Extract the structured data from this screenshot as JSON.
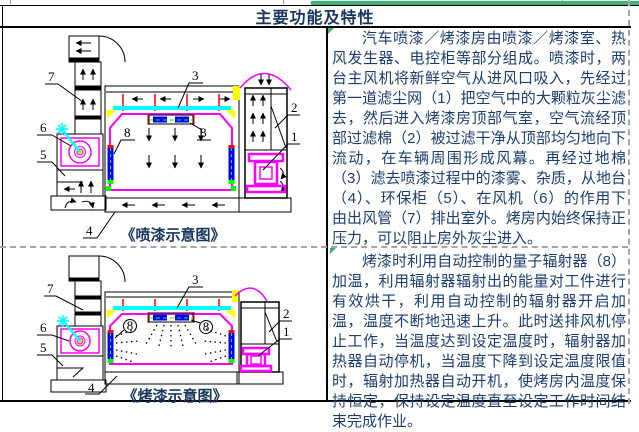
{
  "title": "主要功能及特性",
  "text_panel": {
    "para1": "汽车喷漆／烤漆房由喷漆／烤漆室、热风发生器、电控柜等部分组成。喷漆时，两台主风机将新鲜空气从进风口吸入，先经过第一道滤尘网（1）把空气中的大颗粒灰尘滤去，然后进入烤漆房顶部气室，空气流经顶部过滤棉（2）被过滤干净从顶部均匀地向下流动，在车辆周围形成风幕。再经过地棉（3）滤去喷漆过程中的漆雾、杂质，从地台（4）、环保柜（5）、在风机（6）的作用下由出风管（7）排出室外。烤房内始终保持正压力，可以阻止房外灰尘进入。",
    "para2": "烤漆时利用自动控制的量子辐射器（8）加温，利用辐射器辐射出的能量对工件进行有效烘干，利用自动控制的辐射器开启加温，温度不断地迅速上升。此时送排风机停止工作，当温度达到设定温度时，辐射器加热器自动停机，当温度下降到设定温度限值时，辐射加热器自动开机，使烤房内温度保持恒定，保持设定温度直至设定工作时间结束完成作业。"
  },
  "diagram1": {
    "caption": "《喷漆示意图》",
    "labels": {
      "n1": "1",
      "n2": "2",
      "n3": "3",
      "n4": "4",
      "n5": "5",
      "n6": "6",
      "n7": "7",
      "n8": "8"
    }
  },
  "diagram2": {
    "caption": "《烤漆示意图》",
    "labels": {
      "n1": "1",
      "n2": "2",
      "n3": "3",
      "n4": "4",
      "n5": "5",
      "n6": "6",
      "n7": "7",
      "n8": "8"
    }
  },
  "colors": {
    "text_navy": "#1c3e6e",
    "caption_navy": "#17365d",
    "accent_green": "#3cb371",
    "magenta": "#ff00ff",
    "cyan": "#00ffff",
    "yellow": "#ffff00",
    "red": "#ff0000",
    "blue": "#0000ff",
    "green": "#00ff00"
  }
}
